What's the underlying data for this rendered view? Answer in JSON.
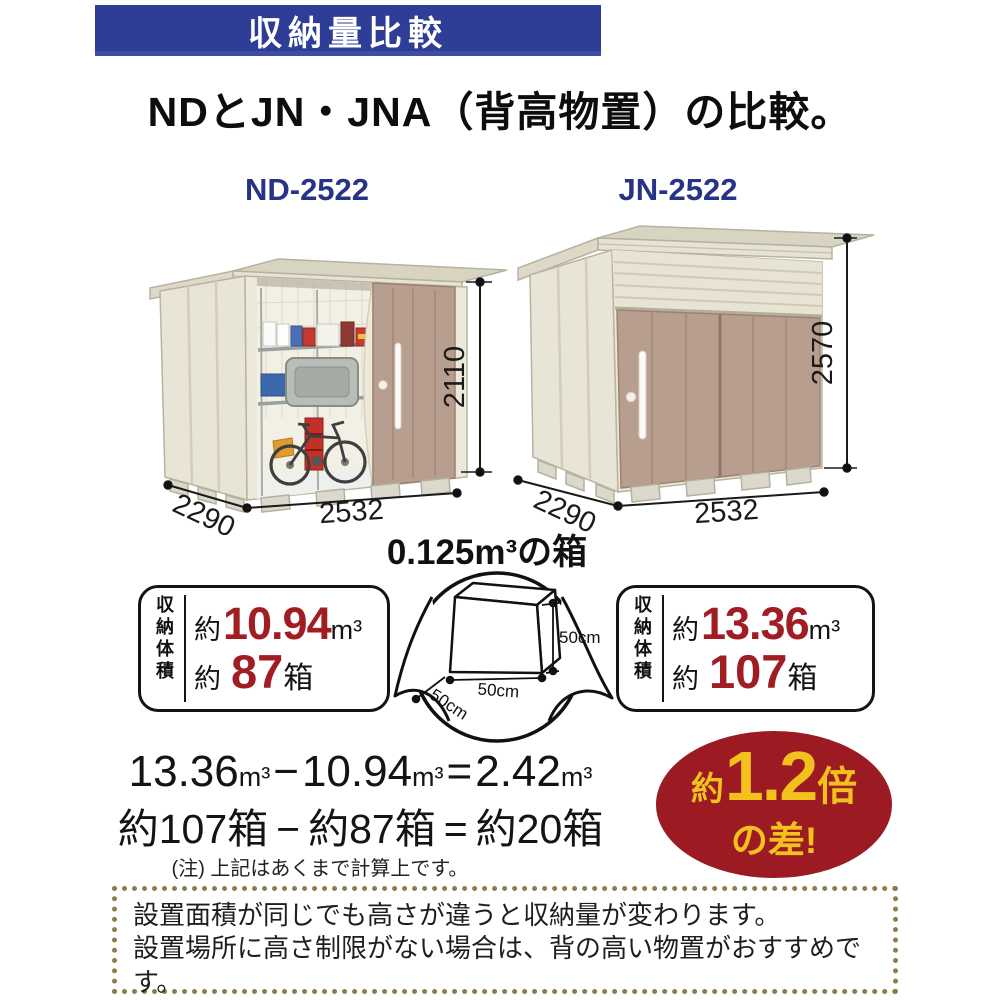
{
  "header": {
    "banner_label": "収納量比較",
    "banner_color": "#2e3d96"
  },
  "subtitle": "NDとJN・JNA（背高物置）の比較。",
  "sheds": {
    "nd": {
      "model": "ND-2522",
      "height_mm": "2110",
      "depth_mm": "2290",
      "width_mm": "2532"
    },
    "jn": {
      "model": "JN-2522",
      "height_mm": "2570",
      "depth_mm": "2290",
      "width_mm": "2532"
    }
  },
  "reference_box": {
    "title": "0.125m³の箱",
    "height_label": "50cm",
    "width_label": "50cm",
    "depth_label": "50cm"
  },
  "volume_panels": {
    "side_label": "収納体積",
    "nd": {
      "approx": "約",
      "volume": "10.94",
      "volume_unit": "m³",
      "approx2": "約",
      "boxes": "87",
      "boxes_unit": "箱"
    },
    "jn": {
      "approx": "約",
      "volume": "13.36",
      "volume_unit": "m³",
      "approx2": "約",
      "boxes": "107",
      "boxes_unit": "箱"
    }
  },
  "calculation": {
    "line1": [
      "13.36",
      "m³",
      "−",
      "10.94",
      "m³",
      "=",
      "2.42",
      "m³"
    ],
    "line2": [
      "約107箱",
      "−",
      "約87箱",
      "=",
      "約20箱"
    ],
    "note": "(注) 上記はあくまで計算上です。"
  },
  "difference_badge": {
    "approx": "約",
    "value": "1.2",
    "times": "倍",
    "line2": "の差!",
    "bg": "#9c1b23",
    "text_color": "#f3c11d"
  },
  "footer_note": {
    "lines": [
      "設置面積が同じでも高さが違うと収納量が変わります。",
      "設置場所に高さ制限がない場合は、背の高い物置がおすすめです。",
      "土地を有効に活用できより経済的です。"
    ]
  },
  "colors": {
    "banner_blue": "#2e3d96",
    "model_navy": "#273386",
    "number_red": "#a01d23",
    "badge_red": "#9c1b23",
    "badge_yellow": "#f3c11d",
    "dotted_border": "#8c7d4a",
    "shed_wall": "#e9e5d6",
    "shed_door": "#b79e8f"
  }
}
